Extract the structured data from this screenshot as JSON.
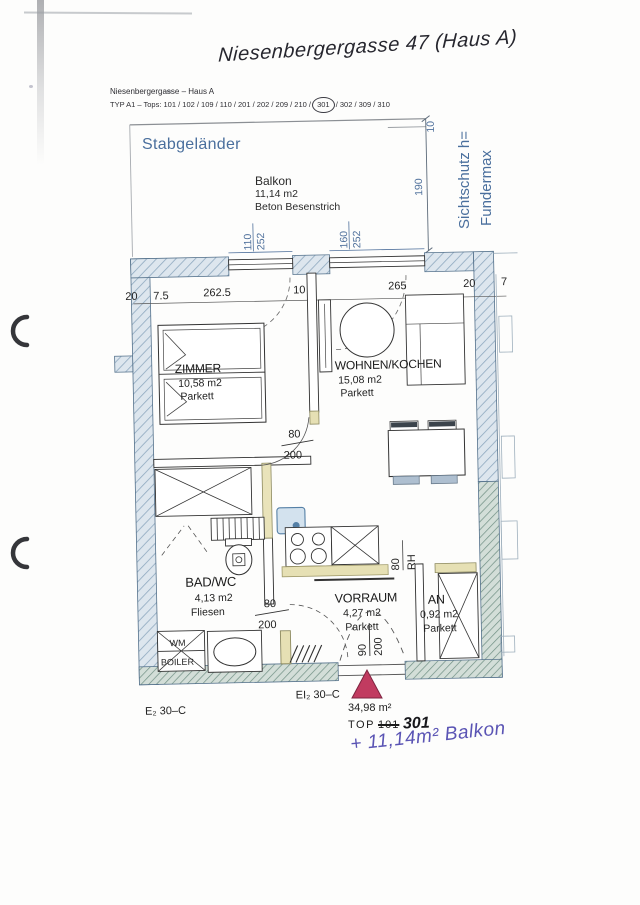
{
  "colors": {
    "annotation_blue": "#4a6f9d",
    "pen_blue": "#5a54b4",
    "entry_triangle": "#c13b60",
    "wall_hatch_blue": "#8fa9bf",
    "wall_hatch_green": "#6f8f83",
    "door_wood_beige": "#e6e0b4"
  },
  "header": {
    "handwritten_title": "Niesenbergergasse 47 (Haus A)",
    "project_line": "Niesenbergergasse – Haus A",
    "type_line_prefix": "TYP A1 – Tops: 101 / 102 / 109 / 110 / 201 / 202 / 209 / 210 /",
    "type_circled": "301",
    "type_line_suffix": "/ 302 / 309 / 310"
  },
  "balcony": {
    "railing_label": "Stabgeländer",
    "name": "Balkon",
    "area": "11,14 m2",
    "finish": "Beton Besenstrich",
    "privacy_screen_line1": "Sichtschutz h=",
    "privacy_screen_line2": "Fundermax",
    "depth_dim": "190",
    "railing_dim": "10"
  },
  "rooms": [
    {
      "name": "ZIMMER",
      "area": "10,58 m2",
      "floor": "Parkett"
    },
    {
      "name": "WOHNEN/KOCHEN",
      "area": "15,08 m2",
      "floor": "Parkett"
    },
    {
      "name": "BAD/WC",
      "area": "4,13 m2",
      "floor": "Fliesen"
    },
    {
      "name": "VORRAUM",
      "area": "4,27 m2",
      "floor": "Parkett"
    },
    {
      "name": "AN",
      "area": "0,92 m2",
      "floor": "Parkett"
    }
  ],
  "dimensions": {
    "top_row": [
      "20",
      "7.5",
      "262.5",
      "10",
      "265",
      "20",
      "7"
    ],
    "window_left": {
      "w": "110",
      "h": "252"
    },
    "window_right": {
      "w": "160",
      "h": "252"
    },
    "door_room": {
      "w": "80",
      "h": "200"
    },
    "door_bath": {
      "w": "80",
      "h": "200"
    },
    "door_entry": {
      "w": "90",
      "h": "200"
    },
    "kitchen": {
      "w": "80",
      "note": "RH"
    }
  },
  "labels": {
    "wm": "WM",
    "boiler": "BOILER",
    "fire_rating_left": "E₂ 30–C",
    "fire_rating_right": "EI₂ 30–C"
  },
  "summary": {
    "total_area": "34,98 m²",
    "top_label": "TOP",
    "top_number_old": "101",
    "top_number_new": "301",
    "handwritten_note": "+ 11,14m² Balkon"
  }
}
